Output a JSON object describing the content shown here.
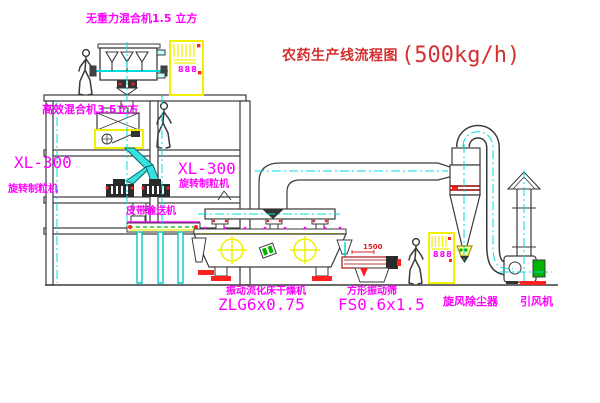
{
  "diagram": {
    "title": {
      "name_cn": "农药生产线流程图",
      "capacity": "(500kg/h)"
    },
    "equipment_labels": {
      "top_mixer": "无重力混合机1.5 立方",
      "mid_mixer": "高效混合机3.5立方",
      "granulator_left_model": "XL-300",
      "granulator_left_name": "旋转制粒机",
      "granulator_right_model": "XL-300",
      "granulator_right_name": "旋转制粒机",
      "belt_conveyor": "皮带输送机",
      "dryer_name": "振动流化床干燥机",
      "dryer_model": "ZLG6x0.75",
      "sieve_name": "方形振动筛",
      "sieve_model": "FS0.6x1.5",
      "cyclone_name": "旋风除尘器",
      "fan_name": "引风机"
    },
    "dimensions": {
      "dryer_dim": "1500"
    },
    "cabinet_display": "888",
    "colors": {
      "label_magenta": "#ff00ff",
      "title_red": "#d43030",
      "centerline_cyan": "#00dcdc",
      "highlight_yellow": "#f0f000",
      "machine_green": "#00b400",
      "alert_red": "#ff2020"
    }
  }
}
